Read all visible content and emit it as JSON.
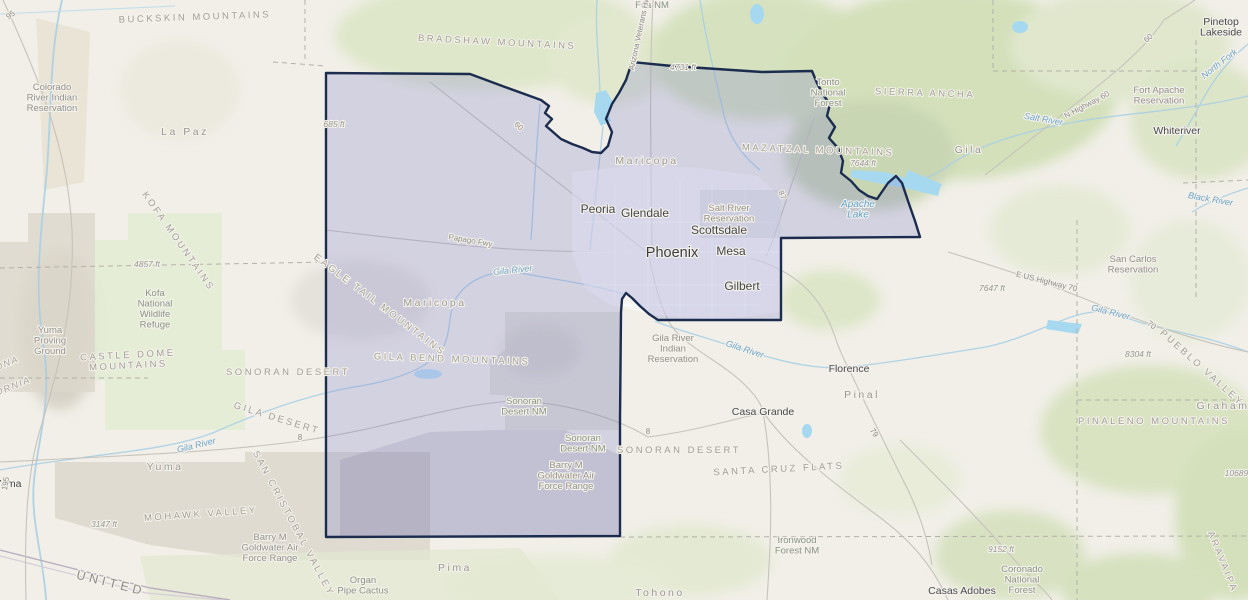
{
  "map": {
    "kind": "topographic web map with highlighted county",
    "region": "Maricopa County",
    "state": "Arizona",
    "colors": {
      "land_base": "#f1efe8",
      "terrain_green": "#d6e2bf",
      "terrain_gray": "#dcd7cb",
      "water": "#a9cfe4",
      "lake": "#a6d9f0",
      "county_fill": "rgba(128,128,204,0.26)",
      "county_border": "#1b2c4e",
      "road": "#c6c3bb",
      "dashed_admin": "#b3b1a9"
    },
    "labels": {
      "cities": [
        {
          "t": "Phoenix",
          "x": 672,
          "y": 257,
          "c": "city-lg"
        },
        {
          "t": "Mesa",
          "x": 731,
          "y": 255,
          "c": "city-md"
        },
        {
          "t": "Scottsdale",
          "x": 719,
          "y": 234,
          "c": "city-md"
        },
        {
          "t": "Glendale",
          "x": 645,
          "y": 217,
          "c": "city-md"
        },
        {
          "t": "Peoria",
          "x": 598,
          "y": 213,
          "c": "city-md"
        },
        {
          "t": "Gilbert",
          "x": 742,
          "y": 290,
          "c": "city-md"
        },
        {
          "t": "Florence",
          "x": 849,
          "y": 372,
          "c": "city-sm"
        },
        {
          "t": "Casa Grande",
          "x": 763,
          "y": 415,
          "c": "city-sm"
        },
        {
          "t": "Casas Adobes",
          "x": 962,
          "y": 594,
          "c": "city-sm"
        },
        {
          "t": "Whiteriver",
          "x": 1177,
          "y": 134,
          "c": "city-sm"
        },
        {
          "t": [
            "Pinetop",
            "Lakeside"
          ],
          "x": 1221,
          "y": 25,
          "c": "city-sm"
        },
        {
          "t": "Yuma",
          "x": 8,
          "y": 487,
          "c": "city-sm"
        }
      ],
      "counties": [
        {
          "t": "La Paz",
          "x": 185,
          "y": 135,
          "c": "county"
        },
        {
          "t": "Maricopa",
          "x": 647,
          "y": 164,
          "c": "county"
        },
        {
          "t": "Maricopa",
          "x": 435,
          "y": 306,
          "c": "county"
        },
        {
          "t": "Yuma",
          "x": 165,
          "y": 470,
          "c": "county"
        },
        {
          "t": "Pima",
          "x": 455,
          "y": 571,
          "c": "county"
        },
        {
          "t": "Pinal",
          "x": 862,
          "y": 398,
          "c": "county"
        },
        {
          "t": "Gila",
          "x": 969,
          "y": 153,
          "c": "county"
        },
        {
          "t": "Graham",
          "x": 1223,
          "y": 409,
          "c": "county"
        },
        {
          "t": "Tohono",
          "x": 660,
          "y": 596,
          "c": "county"
        }
      ],
      "mountains": [
        {
          "t": "BUCKSKIN MOUNTAINS",
          "x": 195,
          "y": 20,
          "r": -2,
          "c": "mountain"
        },
        {
          "t": "BRADSHAW MOUNTAINS",
          "x": 497,
          "y": 45,
          "r": 3,
          "c": "mountain"
        },
        {
          "t": "MAZATZAL MOUNTAINS",
          "x": 818,
          "y": 153,
          "r": 2,
          "c": "mountain"
        },
        {
          "t": "SIERRA ANCHA",
          "x": 925,
          "y": 96,
          "r": 2,
          "c": "mountain"
        },
        {
          "t": "KOFA MOUNTAINS",
          "x": 176,
          "y": 243,
          "r": 55,
          "c": "mountain"
        },
        {
          "t": [
            "CASTLE DOME",
            "MOUNTAINS"
          ],
          "x": 128,
          "y": 358,
          "r": -3,
          "c": "mountain"
        },
        {
          "t": "EAGLE TAIL MOUNTAINS",
          "x": 378,
          "y": 307,
          "r": 37,
          "c": "mountain"
        },
        {
          "t": "GILA BEND MOUNTAINS",
          "x": 452,
          "y": 362,
          "r": 2,
          "c": "mountain"
        },
        {
          "t": "PINALENO MOUNTAINS",
          "x": 1154,
          "y": 424,
          "r": 0,
          "c": "mountain"
        },
        {
          "t": "SONORAN DESERT",
          "x": 288,
          "y": 375,
          "r": 0,
          "c": "mountain"
        },
        {
          "t": "SONORAN DESERT",
          "x": 679,
          "y": 453,
          "r": 0,
          "c": "mountain"
        },
        {
          "t": "SANTA CRUZ FLATS",
          "x": 779,
          "y": 472,
          "r": -3,
          "c": "mountain"
        },
        {
          "t": "MOHAWK VALLEY",
          "x": 201,
          "y": 517,
          "r": -4,
          "c": "mountain"
        },
        {
          "t": "SAN CRISTOBAL VALLEY",
          "x": 291,
          "y": 525,
          "r": 62,
          "c": "mountain"
        },
        {
          "t": "GILA DESERT",
          "x": 276,
          "y": 421,
          "r": 17,
          "c": "mountain"
        },
        {
          "t": "PUEBLO VALLEY",
          "x": 1200,
          "y": 370,
          "r": 42,
          "c": "mountain"
        },
        {
          "t": "ARAVAIPA",
          "x": 1220,
          "y": 563,
          "r": 68,
          "c": "mountain"
        }
      ],
      "areas": [
        {
          "t": [
            "Colorado",
            "River Indian",
            "Reservation"
          ],
          "x": 52,
          "y": 90,
          "c": "res"
        },
        {
          "t": [
            "Fort Apache",
            "Reservation"
          ],
          "x": 1159,
          "y": 93,
          "c": "res"
        },
        {
          "t": [
            "San Carlos",
            "Reservation"
          ],
          "x": 1133,
          "y": 262,
          "c": "res"
        },
        {
          "t": [
            "Salt River",
            "Reservation"
          ],
          "x": 729,
          "y": 211,
          "c": "res"
        },
        {
          "t": [
            "Gila River",
            "Indian",
            "Reservation"
          ],
          "x": 673,
          "y": 341,
          "c": "res"
        },
        {
          "t": [
            "Kofa",
            "National",
            "Wildlife",
            "Refuge"
          ],
          "x": 155,
          "y": 296,
          "c": "land"
        },
        {
          "t": [
            "Yuma",
            "Proving",
            "Ground"
          ],
          "x": 50,
          "y": 333,
          "c": "res"
        },
        {
          "t": [
            "Sonoran",
            "Desert NM"
          ],
          "x": 524,
          "y": 404,
          "c": "land"
        },
        {
          "t": [
            "Sonoran",
            "Desert NM"
          ],
          "x": 583,
          "y": 441,
          "c": "land"
        },
        {
          "t": [
            "Barry M",
            "Goldwater Air",
            "Force Range"
          ],
          "x": 566,
          "y": 468,
          "c": "res"
        },
        {
          "t": [
            "Barry M",
            "Goldwater Air",
            "Force Range"
          ],
          "x": 270,
          "y": 540,
          "c": "res"
        },
        {
          "t": [
            "Organ",
            "Pipe Cactus"
          ],
          "x": 363,
          "y": 583,
          "c": "land"
        },
        {
          "t": [
            "Ironwood",
            "Forest NM"
          ],
          "x": 797,
          "y": 543,
          "c": "land"
        },
        {
          "t": [
            "Coronado",
            "National",
            "Forest"
          ],
          "x": 1022,
          "y": 572,
          "c": "land"
        },
        {
          "t": [
            "Tonto",
            "National",
            "Forest"
          ],
          "x": 828,
          "y": 85,
          "c": "land"
        },
        {
          "t": "Fria NM",
          "x": 652,
          "y": 8,
          "c": "land"
        }
      ],
      "waters": [
        {
          "t": "Gila River",
          "x": 513,
          "y": 273,
          "r": -6,
          "c": "water"
        },
        {
          "t": "Gila River",
          "x": 197,
          "y": 448,
          "r": -14,
          "c": "water"
        },
        {
          "t": "Gila River",
          "x": 744,
          "y": 352,
          "r": 18,
          "c": "water"
        },
        {
          "t": "Gila River",
          "x": 1110,
          "y": 315,
          "r": 14,
          "c": "water"
        },
        {
          "t": "Salt River",
          "x": 1043,
          "y": 122,
          "r": 10,
          "c": "water"
        },
        {
          "t": "Black River",
          "x": 1210,
          "y": 202,
          "r": 10,
          "c": "water"
        },
        {
          "t": "North Fork",
          "x": 1221,
          "y": 66,
          "r": -38,
          "c": "water"
        },
        {
          "t": [
            "Apache",
            "Lake"
          ],
          "x": 858,
          "y": 207,
          "r": 0,
          "c": "water-lg"
        }
      ],
      "roads": [
        {
          "t": "Papago Fwy",
          "x": 470,
          "y": 243,
          "r": 10,
          "c": "road"
        },
        {
          "t": "E US Highway 70",
          "x": 1046,
          "y": 284,
          "r": 14,
          "c": "road"
        },
        {
          "t": "N Highway 60",
          "x": 1088,
          "y": 107,
          "r": -28,
          "c": "road"
        },
        {
          "t": "Arizona Veterans Hwy",
          "x": 642,
          "y": 32,
          "r": -78,
          "c": "road"
        },
        {
          "t": "95",
          "x": 12,
          "y": 17,
          "r": -35,
          "c": "road"
        },
        {
          "t": "195",
          "x": 8,
          "y": 484,
          "r": -80,
          "c": "road"
        },
        {
          "t": "60",
          "x": 517,
          "y": 128,
          "r": 42,
          "c": "road"
        },
        {
          "t": "60",
          "x": 1150,
          "y": 40,
          "r": -42,
          "c": "road"
        },
        {
          "t": "8",
          "x": 300,
          "y": 440,
          "r": 0,
          "c": "road"
        },
        {
          "t": "8",
          "x": 648,
          "y": 434,
          "r": 0,
          "c": "road"
        },
        {
          "t": "87",
          "x": 780,
          "y": 196,
          "r": 65,
          "c": "road"
        },
        {
          "t": "79",
          "x": 872,
          "y": 434,
          "r": 55,
          "c": "road"
        },
        {
          "t": "70",
          "x": 1150,
          "y": 327,
          "r": 38,
          "c": "road"
        }
      ],
      "elevations": [
        {
          "t": "685 ft",
          "x": 334,
          "y": 127,
          "c": "elev"
        },
        {
          "t": "4731 ft",
          "x": 683,
          "y": 70,
          "c": "elev"
        },
        {
          "t": "4857 ft",
          "x": 147,
          "y": 267,
          "c": "elev"
        },
        {
          "t": "3147 ft",
          "x": 104,
          "y": 527,
          "c": "elev"
        },
        {
          "t": "7644 ft",
          "x": 863,
          "y": 166,
          "c": "elev"
        },
        {
          "t": "7647 ft",
          "x": 992,
          "y": 291,
          "c": "elev"
        },
        {
          "t": "8304 ft",
          "x": 1138,
          "y": 357,
          "c": "elev"
        },
        {
          "t": "9152 ft",
          "x": 1001,
          "y": 552,
          "c": "elev"
        },
        {
          "t": "10689 ft",
          "x": 1240,
          "y": 476,
          "c": "elev"
        }
      ],
      "states": [
        {
          "t": "ONA",
          "x": 8,
          "y": 366,
          "r": -22,
          "c": "state"
        },
        {
          "t": "ORNIA",
          "x": 14,
          "y": 389,
          "r": -22,
          "c": "state"
        },
        {
          "t": "UNITED",
          "x": 110,
          "y": 587,
          "r": 14,
          "c": "state-lg"
        }
      ]
    }
  }
}
